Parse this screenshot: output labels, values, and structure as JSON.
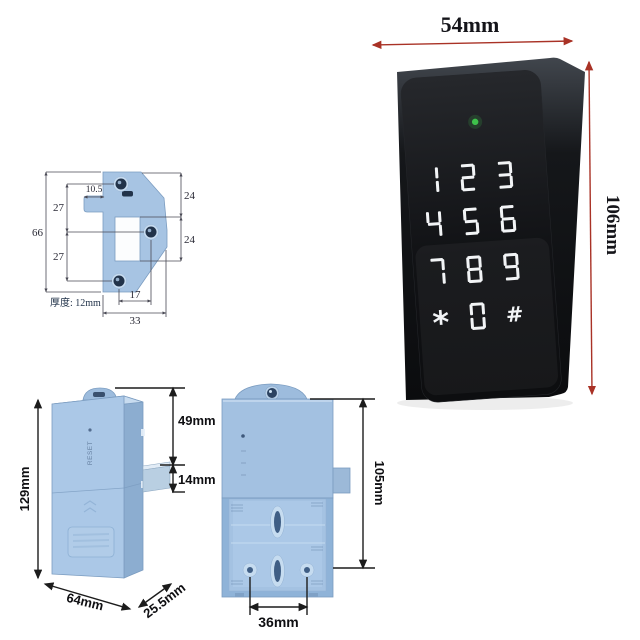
{
  "background_color": "#ffffff",
  "keypad_view": {
    "description": "black touch keypad lock front panel",
    "width_dim": "54mm",
    "height_dim": "106mm",
    "dim_arrow_color": "#a93226",
    "led_color": "#3ec24b",
    "body_color": "#141619",
    "key_color": "#f2f4f6",
    "keys": [
      "1",
      "2",
      "3",
      "4",
      "5",
      "6",
      "7",
      "8",
      "9",
      "*",
      "0",
      "#"
    ]
  },
  "strike_plate_view": {
    "description": "strike plate technical drawing",
    "part_color": "#a7c4e3",
    "dims": {
      "total_height": "66",
      "hole_pitch_upper": "27",
      "hole_pitch_lower": "27",
      "tab_width": "10.5",
      "window_top_offset": "24",
      "window_height": "24",
      "hole_offset": "17",
      "total_width": "33",
      "thickness": "厚度: 12mm"
    }
  },
  "lock_body_side_view": {
    "description": "blue lock body side view",
    "body_color": "#abc8e7",
    "height_dim": "129mm",
    "latch_top_offset_dim": "49mm",
    "latch_height_dim": "14mm",
    "width_dim": "64mm",
    "depth_dim": "25.5mm",
    "reset_label": "RESET"
  },
  "lock_body_back_view": {
    "description": "blue lock body back view with battery compartment",
    "body_color": "#a3c1e1",
    "height_dim": "105mm",
    "screw_spacing_dim": "36mm"
  }
}
